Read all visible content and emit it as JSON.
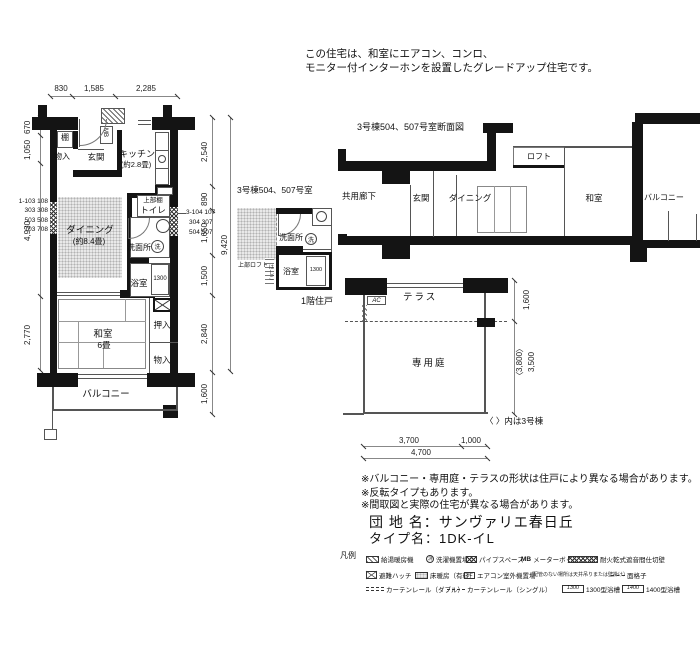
{
  "header_note": {
    "line1": "この住宅は、和室にエアコン、コンロ、",
    "line2": "モニター付インターホンを設置したグレードアップ住宅です。"
  },
  "main_plan": {
    "dims": {
      "top": [
        "830",
        "1,585",
        "2,285"
      ],
      "left": [
        "670",
        "1,050",
        "4,930",
        "2,770"
      ],
      "right": [
        "2,540",
        "890",
        "1,650",
        "1,500",
        "2,840"
      ],
      "balcony": "1,600",
      "total": "9,420"
    },
    "units_left": [
      "1-103 108",
      "303 308",
      "503 508",
      "703 708"
    ],
    "units_right": [
      "3-104 107",
      "304 307",
      "504 507"
    ],
    "labels": {
      "shelf": "棚",
      "storage_top": "物入",
      "entrance": "玄関",
      "mb": "MB",
      "kitchen": "キッチン",
      "kitchen_size": "(約2.8畳)",
      "upper_shelf": "上部棚",
      "toilet": "トイレ",
      "dining": "ダイニング",
      "dining_size": "(約8.4畳)",
      "washroom": "洗面所",
      "washer": "洗",
      "bath": "浴室",
      "tub": "1300",
      "oshiire": "押入",
      "washitsu": "和室",
      "washitsu_size": "6畳",
      "storage_bottom": "物入",
      "balcony": "バルコニー"
    }
  },
  "small_plan": {
    "title": "3号棟504、507号室",
    "loft": "上部ロフト",
    "ladder": "はしご",
    "washroom": "洗面所",
    "washer": "洗",
    "bath": "浴室",
    "tub": "1300",
    "floor_note": "1階住戸"
  },
  "section": {
    "title": "3号棟504、507号室断面図",
    "corridor": "共用廊下",
    "entrance": "玄関",
    "dining": "ダイニング",
    "loft": "ロフト",
    "washitsu": "和室",
    "balcony": "バルコニー"
  },
  "garden": {
    "terrace": "テラス",
    "ac": "AC",
    "garden": "専用庭",
    "dim_side_top": "1,600",
    "dim_side_alt": "〈3,800〉",
    "dim_side": "3,500",
    "dim_b1": "3,700",
    "dim_b2": "1,000",
    "dim_b3": "4,700",
    "note": "〈 〉内は3号棟"
  },
  "notes": [
    "※バルコニー・専用庭・テラスの形状は住戸により異なる場合があります。",
    "※反転タイプもあります。",
    "※間取図と実際の住宅が異なる場合があります。"
  ],
  "title_block": {
    "estate": "団 地 名：サンヴァリエ春日丘",
    "type": "タイプ名：1DK-イL"
  },
  "legend": {
    "title": "凡例",
    "boiler": "給湯暖房機",
    "washer_sym": "洗",
    "washer": "洗濯機置場",
    "pipe": "パイプスペース",
    "mb_sym": "MB",
    "mb": "メーターボックス",
    "firewall": "耐火乾式遮音間仕切壁",
    "hatch": "避難ハッチ",
    "floor_heat": "床暖房（有料）",
    "ac_sym": "AC",
    "ac": "エアコン室外機置場",
    "ac_note": "（配管のない場所は天井吊りまたは壁掛け）",
    "grille": "面格子",
    "curtain_double": "カーテンレール（ダブル）",
    "curtain_single": "カーテンレール（シングル）",
    "tub1300_sym": "1300",
    "tub1300": "1300型浴槽",
    "tub1400_sym": "1400",
    "tub1400": "1400型浴槽"
  }
}
